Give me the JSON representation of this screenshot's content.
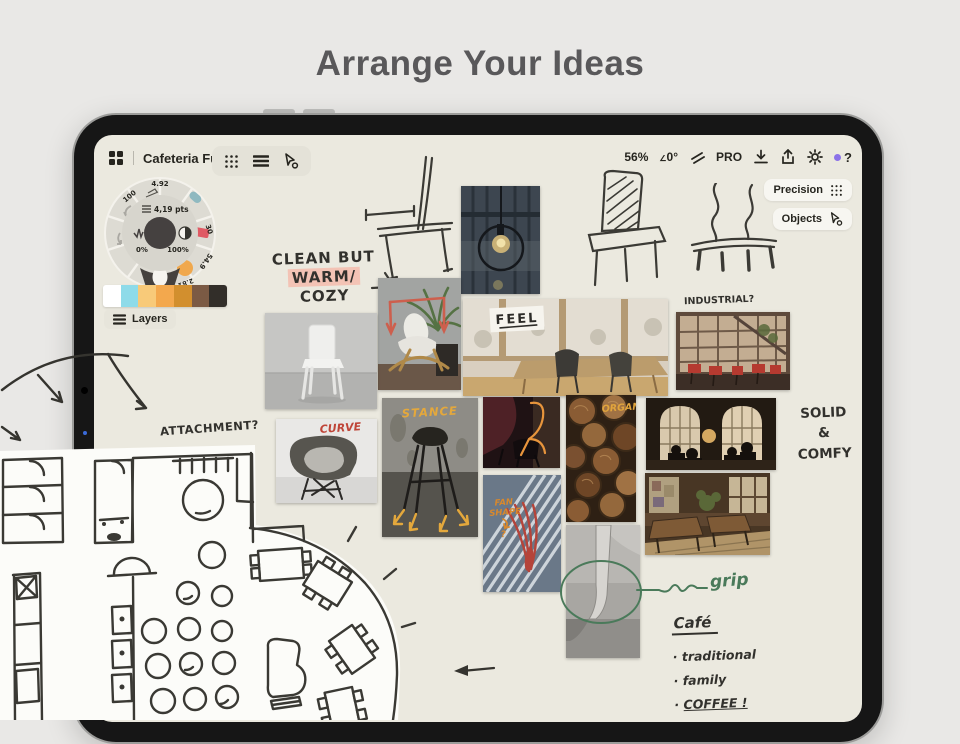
{
  "page": {
    "title": "Arrange Your Ideas"
  },
  "app": {
    "toolbar": {
      "doc_title": "Cafeteria Furni...",
      "zoom_level": "56%",
      "angle": "0°",
      "pro_badge": "PRO",
      "help": "?"
    },
    "side_panels": {
      "precision": "Precision",
      "objects": "Objects"
    },
    "layers_button": "Layers",
    "tool_wheel": {
      "top_value": "4.92",
      "stroke_width": "4,19 pts",
      "opacity_left": "0%",
      "opacity_right": "100%",
      "ring_values": [
        "100",
        "30",
        "54.9",
        "2.81",
        "4,19"
      ]
    },
    "palette": [
      "#ffffff",
      "#8edbe9",
      "#f8ca79",
      "#f3a84d",
      "#d28f2e",
      "#7b5a44",
      "#322e29"
    ]
  },
  "canvas": {
    "notes": {
      "clean_line1": "CLEAN BUT",
      "clean_line2": "WARM/",
      "clean_line3": "COZY",
      "attachment": "ATTACHMENT?",
      "industrial": "INDUSTRIAL?",
      "feel": "FEEL",
      "curve": "CURVE",
      "stance": "STANCE",
      "organic": "ORGANIC",
      "fan_line1": "FAN",
      "fan_line2": "SHAPE",
      "fan_line3": "?",
      "solid_line1": "SOLID",
      "solid_line2": "&",
      "solid_line3": "COMFY",
      "grip": "grip"
    },
    "cafe_list": {
      "title": "Café",
      "bullet": "·",
      "items": [
        "traditional",
        "family",
        "COFFEE !"
      ]
    }
  },
  "colors": {
    "page_bg": "#e9e8e6",
    "canvas_bg": "#ebe9df",
    "ink": "#35342f",
    "highlight_pink": "#f3c3b5",
    "marker_yellow": "#e2a53c",
    "marker_red": "#bf4538",
    "marker_orange": "#e8953c",
    "marker_green": "#4a7a5a",
    "accent_purple": "#8b72e8"
  }
}
